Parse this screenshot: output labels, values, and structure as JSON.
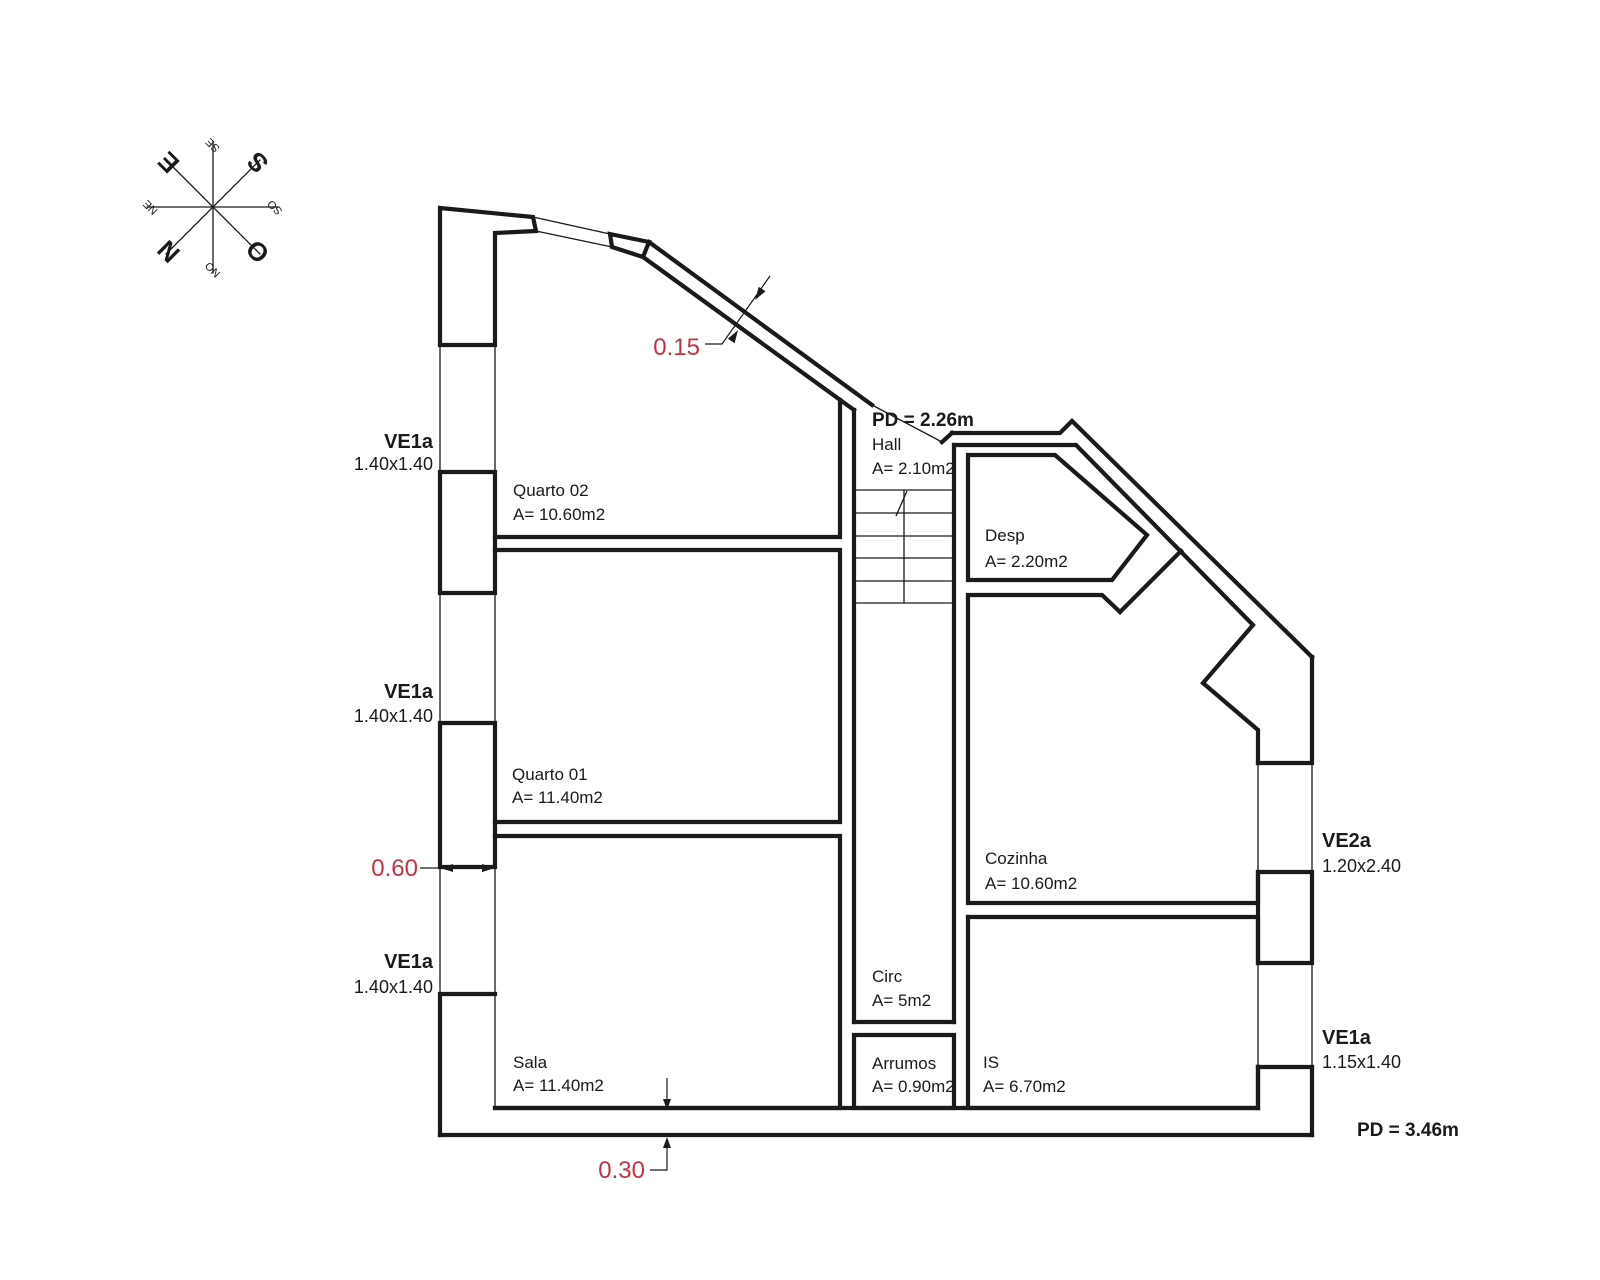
{
  "compass": {
    "n": "N",
    "ne": "NE",
    "e": "E",
    "se": "SE",
    "s": "S",
    "so": "SO",
    "o": "O",
    "no": "NO"
  },
  "rooms": {
    "quarto02": {
      "name": "Quarto 02",
      "area": "A= 10.60m2"
    },
    "quarto01": {
      "name": "Quarto 01",
      "area": "A= 11.40m2"
    },
    "sala": {
      "name": "Sala",
      "area": "A= 11.40m2"
    },
    "hall": {
      "name": "Hall",
      "area": "A= 2.10m2",
      "ceiling": "PD = 2.26m"
    },
    "desp": {
      "name": "Desp",
      "area": "A= 2.20m2"
    },
    "cozinha": {
      "name": "Cozinha",
      "area": "A= 10.60m2"
    },
    "circ": {
      "name": "Circ",
      "area": "A= 5m2"
    },
    "arrumos": {
      "name": "Arrumos",
      "area": "A= 0.90m2"
    },
    "is": {
      "name": "IS",
      "area": "A= 6.70m2"
    }
  },
  "windows": {
    "left1": {
      "code": "VE1a",
      "size": "1.40x1.40"
    },
    "left2": {
      "code": "VE1a",
      "size": "1.40x1.40"
    },
    "left3": {
      "code": "VE1a",
      "size": "1.40x1.40"
    },
    "right1": {
      "code": "VE2a",
      "size": "1.20x2.40"
    },
    "right2": {
      "code": "VE1a",
      "size": "1.15x1.40"
    }
  },
  "ceiling": {
    "main": "PD = 3.46m"
  },
  "dimensions": {
    "roof_wall": "0.15",
    "left_wall": "0.60",
    "bottom_wall": "0.30"
  },
  "colors": {
    "dimension_red": "#c43247",
    "line_black": "#1a1a1a"
  }
}
